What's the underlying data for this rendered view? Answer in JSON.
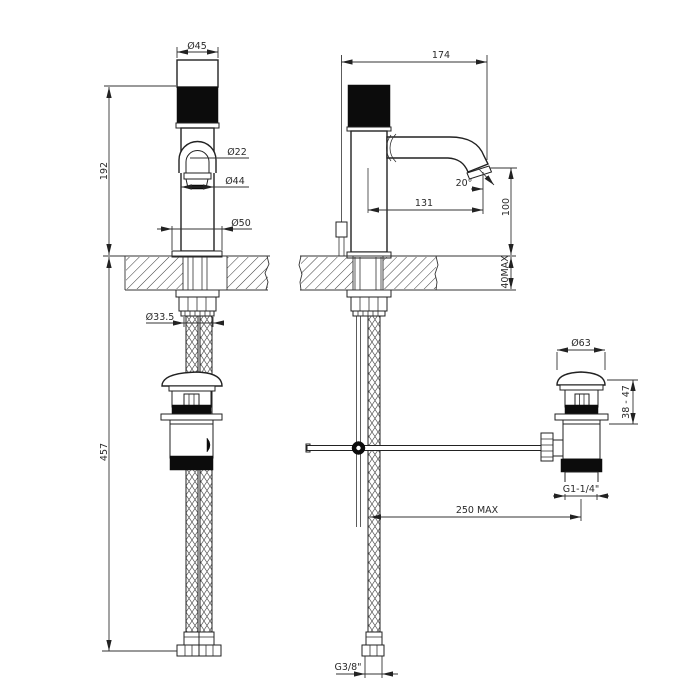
{
  "drawing": {
    "dims": {
      "cap_diameter": "Ø45",
      "overall_depth": "174",
      "height_to_handle": "192",
      "aerator_diameter": "Ø22",
      "body_diameter": "Ø44",
      "base_diameter": "Ø50",
      "spout_angle": "20°",
      "spout_reach": "131",
      "spout_height": "100",
      "counter_thickness_max": "40MAX",
      "shank_diameter": "Ø33.5",
      "below_counter_length": "457",
      "waste_cap_diameter": "Ø63",
      "waste_height_range": "38 - 47",
      "waste_thread": "G1-1/4\"",
      "rod_reach_max": "250 MAX",
      "hose_thread": "G3/8\""
    }
  }
}
